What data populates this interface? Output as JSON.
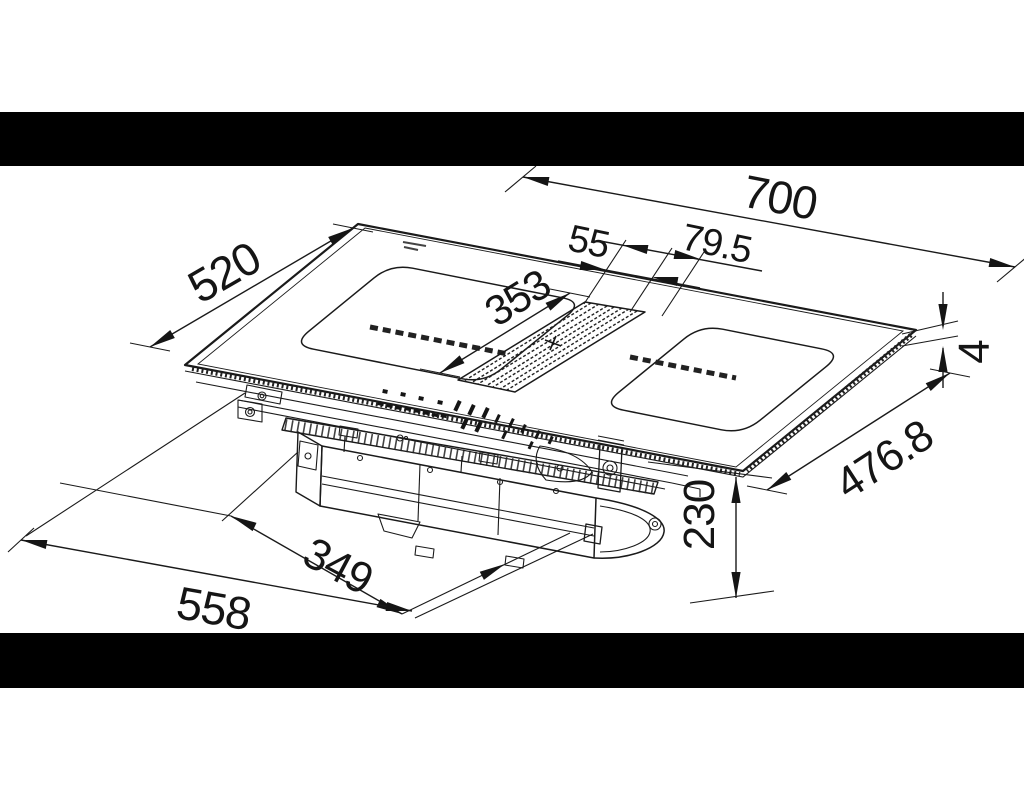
{
  "page": {
    "background": "#ffffff"
  },
  "letterbox": {
    "color": "#000000"
  },
  "drawing": {
    "type": "technical-dimension-drawing",
    "subject": "hob-with-downdraft-extractor-isometric-view",
    "line_color": "#1a1a1a",
    "dimensions": {
      "width_top": "700",
      "depth_left": "520",
      "vent_width": "55",
      "vent_offset": "79.5",
      "vent_length": "353",
      "glass_thickness": "4",
      "depth_right": "476.8",
      "box_width": "349",
      "box_height": "230",
      "bottom_width": "558"
    }
  }
}
